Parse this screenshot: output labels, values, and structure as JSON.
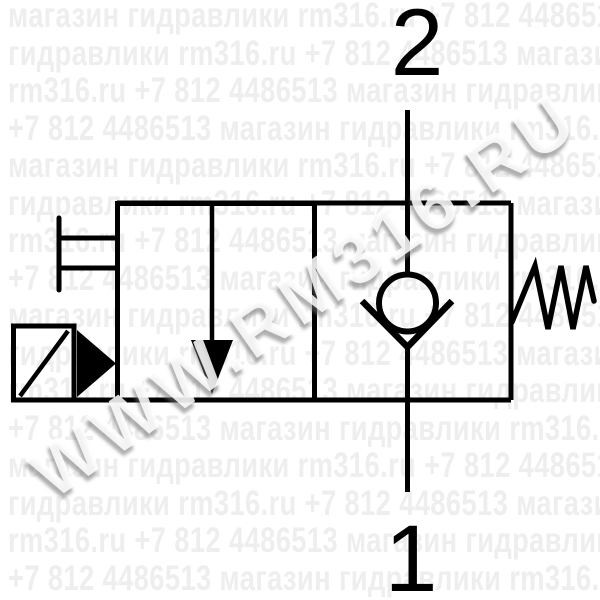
{
  "watermark": {
    "diagonal_text": "WWW.RM316.RU",
    "row_phrases": [
      "магазин гидравлики rm316.ru +7 812 4486513",
      "гидравлики rm316.ru +7 812 4486513 магазин",
      "rm316.ru +7 812 4486513 магазин гидравлики",
      "+7 812 4486513 магазин гидравлики rm316.ru"
    ],
    "row_count": 16,
    "row_pitch_px": 37.5,
    "color": "#eeeeee"
  },
  "schematic": {
    "port_top_label": "2",
    "port_bottom_label": "1",
    "line_color": "#000000",
    "symbols": [
      "solenoid-actuator",
      "manual-override",
      "valve-body",
      "poppet-arrow",
      "check-valve",
      "return-spring"
    ]
  }
}
